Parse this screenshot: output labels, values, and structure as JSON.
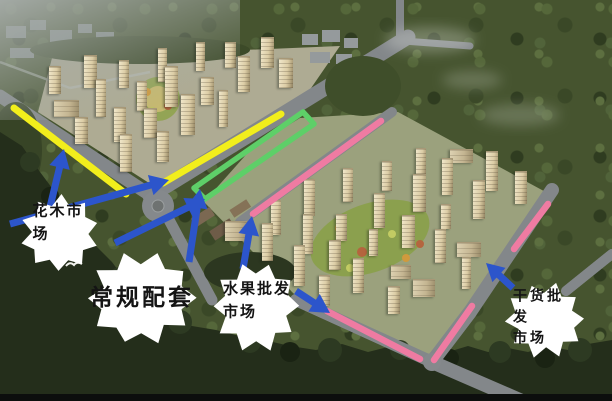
{
  "palette": {
    "yellow": "#f2ee1c",
    "green": "#5ecf68",
    "pink": "#ef7ba2",
    "blue": "#2c55cb",
    "callout_bg": "#ffffff",
    "callout_text": "#141414"
  },
  "callouts": [
    {
      "id": "flower-market",
      "text": "花木市\n场",
      "cx": 60,
      "cy": 233,
      "rx": 38,
      "ry": 36,
      "text_cx": 58,
      "text_cy": 223,
      "font": 15,
      "letter_spacing": 2
    },
    {
      "id": "general-amenities",
      "text": "常规配套",
      "cx": 141,
      "cy": 298,
      "rx": 52,
      "ry": 45,
      "text_cx": 142,
      "text_cy": 297,
      "font": 23,
      "letter_spacing": 3
    },
    {
      "id": "fruit-wholesale-market",
      "text": "水果批发\n市场",
      "cx": 256,
      "cy": 306,
      "rx": 42,
      "ry": 43,
      "text_cx": 257,
      "text_cy": 301,
      "font": 15,
      "letter_spacing": 2
    },
    {
      "id": "dried-goods-wholesale-market",
      "text": "干货批发\n市场",
      "cx": 545,
      "cy": 320,
      "rx": 38,
      "ry": 36,
      "text_cx": 546,
      "text_cy": 317,
      "font": 14,
      "letter_spacing": 3
    }
  ],
  "highlight_lines": [
    {
      "id": "yellow-line-west-road",
      "color": "yellow",
      "width": 7,
      "points": [
        [
          14,
          108
        ],
        [
          126,
          194
        ]
      ]
    },
    {
      "id": "yellow-line-main-road",
      "color": "yellow",
      "width": 7,
      "points": [
        [
          163,
          183
        ],
        [
          281,
          114
        ]
      ]
    },
    {
      "id": "green-loop-commercial-strip",
      "color": "green",
      "width": 5.5,
      "closed": true,
      "points": [
        [
          303,
          112
        ],
        [
          194,
          188
        ],
        [
          205,
          199
        ],
        [
          314,
          124
        ]
      ]
    },
    {
      "id": "pink-line-northwest-road",
      "color": "pink",
      "width": 6.5,
      "points": [
        [
          381,
          121
        ],
        [
          253,
          214
        ]
      ]
    },
    {
      "id": "pink-line-east-road-upper",
      "color": "pink",
      "width": 6.5,
      "points": [
        [
          548,
          204
        ],
        [
          514,
          249
        ]
      ]
    },
    {
      "id": "pink-line-east-road-lower",
      "color": "pink",
      "width": 6.5,
      "points": [
        [
          472,
          306
        ],
        [
          434,
          360
        ]
      ]
    },
    {
      "id": "pink-line-south-road",
      "color": "pink",
      "width": 6.5,
      "points": [
        [
          327,
          311
        ],
        [
          420,
          359
        ]
      ]
    }
  ],
  "arrows": [
    {
      "id": "arrow-flower-to-west-road",
      "from": [
        50,
        207
      ],
      "to": [
        64,
        149
      ]
    },
    {
      "id": "arrow-flower-to-main-road",
      "from": [
        10,
        224
      ],
      "to": [
        169,
        180
      ]
    },
    {
      "id": "arrow-amenities-vertical",
      "from": [
        189,
        262
      ],
      "to": [
        200,
        189
      ]
    },
    {
      "id": "arrow-amenities-diagonal",
      "from": [
        115,
        243
      ],
      "to": [
        205,
        199
      ]
    },
    {
      "id": "arrow-fruit-up",
      "from": [
        243,
        269
      ],
      "to": [
        252,
        216
      ]
    },
    {
      "id": "arrow-fruit-down",
      "from": [
        296,
        291
      ],
      "to": [
        330,
        313
      ]
    },
    {
      "id": "arrow-drygoods-upleft",
      "from": [
        513,
        288
      ],
      "to": [
        486,
        263
      ]
    }
  ]
}
